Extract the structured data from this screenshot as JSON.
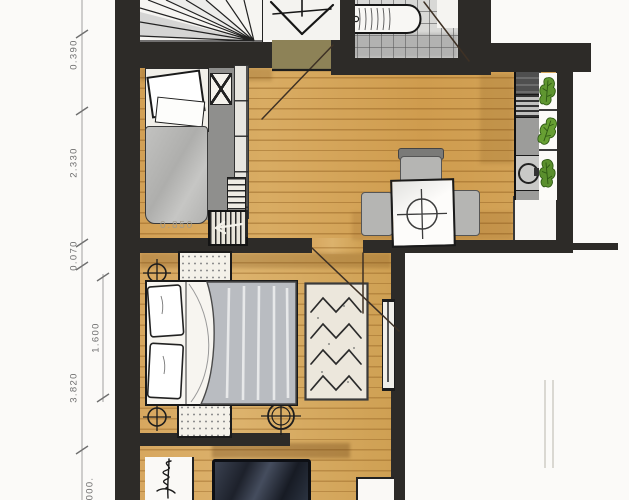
{
  "dimensions": {
    "outer": [
      {
        "label": "0.390"
      },
      {
        "label": "2.330"
      },
      {
        "label": "0.070"
      },
      {
        "label": "3.820"
      },
      {
        "label": "000."
      }
    ],
    "inner": [
      {
        "label": "1.600"
      }
    ],
    "floor_note": {
      "label": "0.850"
    }
  },
  "icons": {
    "stair_fan": "stair-fan",
    "stair_direction_arrow": "stair-direction-arrow",
    "bathtub": "bathtub",
    "ceiling_light": "circle-cross-light",
    "sink": "round-sink",
    "plant": "potted-plant",
    "door_swing": "door-swing-line"
  },
  "colors": {
    "paper": "#fbfaf8",
    "wall": "#2d2b28",
    "wood": "#d6a65d",
    "entry_floor": "#8d8257",
    "tile": "#d8d8d6",
    "furniture_gray": "#b5b5b3",
    "duvet_gray": "#b9bcc1",
    "plant_green": "#5f9630",
    "plant_dark": "#2f5a14",
    "navy_furniture": "#1d212b",
    "rug": "#ece7dc",
    "dim_text": "#6f6f6f"
  }
}
